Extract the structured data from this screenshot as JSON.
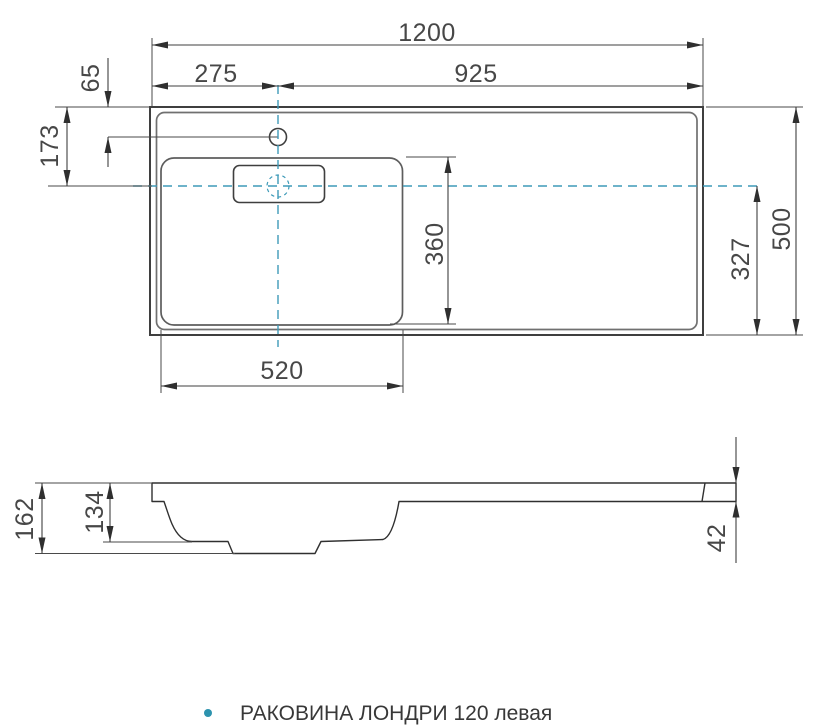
{
  "drawing": {
    "type": "technical-drawing",
    "line_color": "#3f3f3f",
    "centerline_color": "#3e9ab8",
    "accent_bullet_color": "#2d93ae"
  },
  "dimensions": {
    "overall_width": "1200",
    "left_edge_to_faucet": "275",
    "faucet_to_right_edge": "925",
    "top_edge_to_faucet": "65",
    "top_edge_to_basin_center": "173",
    "overall_depth": "500",
    "basin_inner_depth": "360",
    "basin_center_to_front": "327",
    "basin_width": "520",
    "overall_height": "162",
    "bowl_depth": "134",
    "deck_thickness": "42"
  },
  "caption": {
    "bullet": "•",
    "text": "РАКОВИНА ЛОНДРИ 120 левая"
  }
}
